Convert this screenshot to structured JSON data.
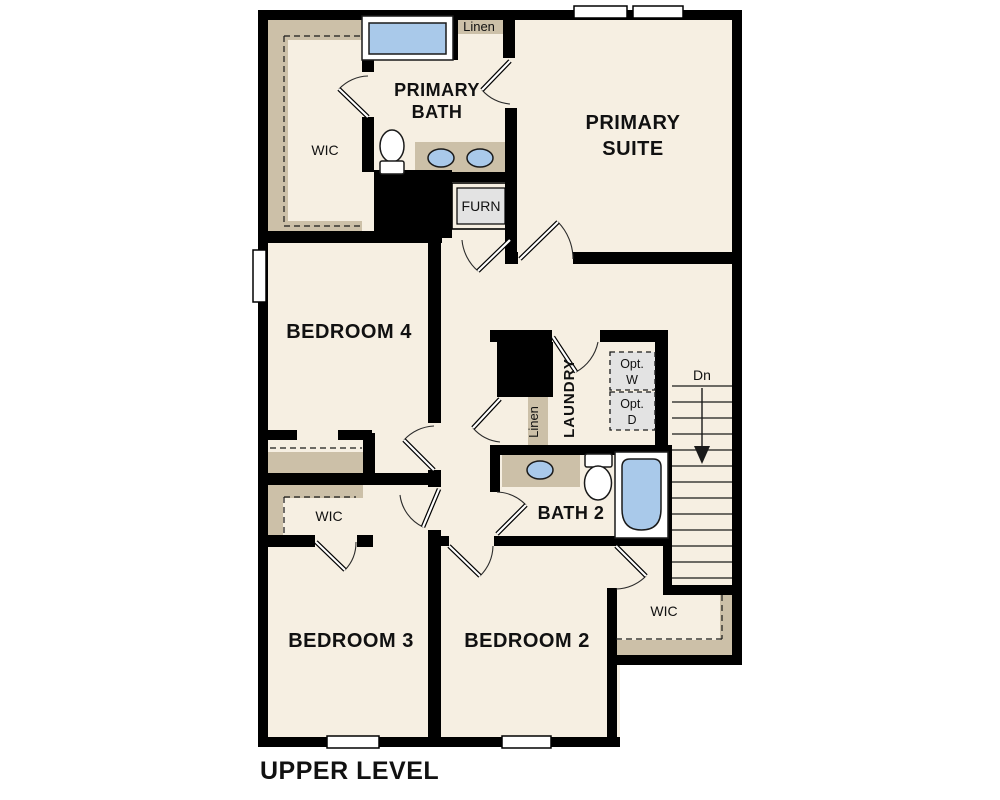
{
  "palette": {
    "floor": "#f6efe2",
    "wall": "#000000",
    "casework": "#ccc0a8",
    "fixture_blue": "#a9c9ea",
    "appliance_gray": "#e3e3e3"
  },
  "plan": {
    "title": "UPPER LEVEL",
    "rooms": {
      "primary_suite": {
        "line1": "PRIMARY",
        "line2": "SUITE"
      },
      "primary_bath": {
        "line1": "PRIMARY",
        "line2": "BATH"
      },
      "bedroom4": {
        "label": "BEDROOM 4"
      },
      "bedroom3": {
        "label": "BEDROOM 3"
      },
      "bedroom2": {
        "label": "BEDROOM 2"
      },
      "bath2": {
        "label": "BATH 2"
      },
      "laundry": {
        "label": "LAUNDRY"
      }
    },
    "closets": {
      "wic_primary": "WIC",
      "wic_bedroom3": "WIC",
      "wic_bedroom2": "WIC",
      "linen_upper": "Linen",
      "linen_hall": "Linen"
    },
    "utility": {
      "furnace": "FURN",
      "opt_washer_line1": "Opt.",
      "opt_washer_line2": "W",
      "opt_dryer_line1": "Opt.",
      "opt_dryer_line2": "D"
    },
    "stairs": {
      "direction": "Dn"
    }
  }
}
